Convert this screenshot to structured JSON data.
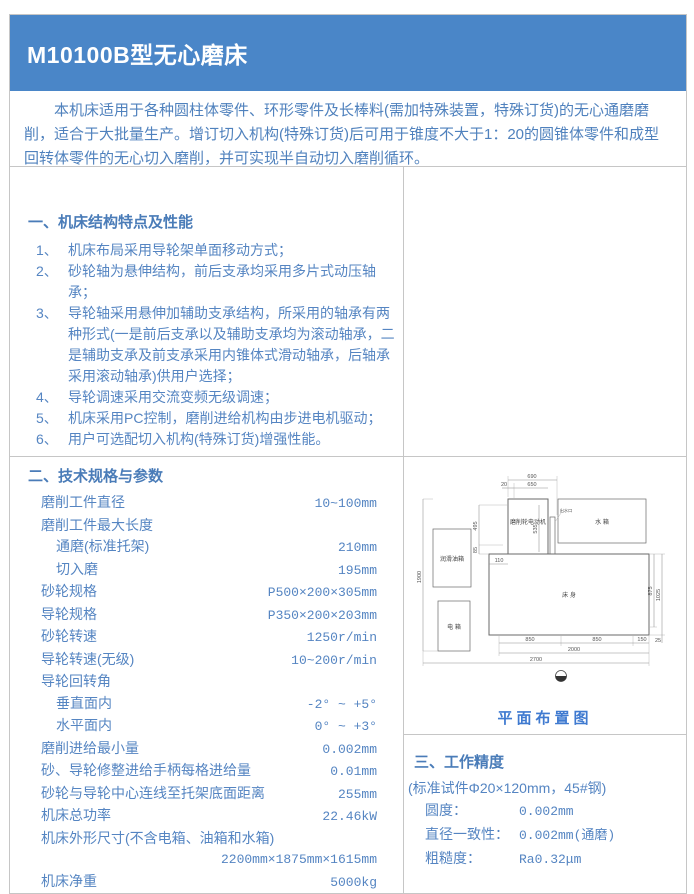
{
  "page": {
    "title": "M10100B型无心磨床"
  },
  "intro": {
    "text": "本机床适用于各种圆柱体零件、环形零件及长棒料(需加特殊装置，特殊订货)的无心通磨磨削，适合于大批量生产。增订切入机构(特殊订货)后可用于锥度不大于1：20的圆锥体零件和成型回转体零件的无心切入磨削，并可实现半自动切入磨削循环。"
  },
  "features": {
    "heading": "一、机床结构特点及性能",
    "items": [
      {
        "num": "1、",
        "text": "机床布局采用导轮架单面移动方式；"
      },
      {
        "num": "2、",
        "text": "砂轮轴为悬伸结构，前后支承均采用多片式动压轴承；"
      },
      {
        "num": "3、",
        "text": "导轮轴采用悬伸加辅助支承结构，所采用的轴承有两种形式(一是前后支承以及辅助支承均为滚动轴承，二是辅助支承及前支承采用内锥体式滑动轴承，后轴承采用滚动轴承)供用户选择；"
      },
      {
        "num": "4、",
        "text": "导轮调速采用交流变频无级调速；"
      },
      {
        "num": "5、",
        "text": "机床采用PC控制，磨削进给机构由步进电机驱动；"
      },
      {
        "num": "6、",
        "text": "用户可选配切入机构(特殊订货)增强性能。"
      }
    ]
  },
  "specs": {
    "heading": "二、技术规格与参数",
    "rows": [
      {
        "label": "磨削工件直径",
        "value": "10~100mm"
      },
      {
        "label": "磨削工件最大长度",
        "value": ""
      },
      {
        "label": "通磨(标准托架)",
        "value": "210mm"
      },
      {
        "label": "切入磨",
        "value": "195mm"
      },
      {
        "label": "砂轮规格",
        "value": "P500×200×305mm"
      },
      {
        "label": "导轮规格",
        "value": "P350×200×203mm"
      },
      {
        "label": "砂轮转速",
        "value": "1250r/min"
      },
      {
        "label": "导轮转速(无级)",
        "value": "10~200r/min"
      },
      {
        "label": "导轮回转角",
        "value": ""
      },
      {
        "label": "垂直面内",
        "value": "-2° ~ +5°"
      },
      {
        "label": "水平面内",
        "value": "0° ~ +3°"
      },
      {
        "label": "磨削进给最小量",
        "value": "0.002mm"
      },
      {
        "label": "砂、导轮修整进给手柄每格进给量",
        "value": "0.01mm"
      },
      {
        "label": "砂轮与导轮中心连线至托架底面距离",
        "value": "255mm"
      },
      {
        "label": "机床总功率",
        "value": "22.46kW"
      },
      {
        "label": "机床外形尺寸(不含电箱、油箱和水箱)",
        "value": ""
      },
      {
        "label": "",
        "value": "2200mm×1875mm×1615mm"
      },
      {
        "label": "机床净重",
        "value": "5000kg"
      }
    ]
  },
  "diagram": {
    "caption": "平面布置图",
    "labels": {
      "bed": "床 身",
      "motor": "磨削轮电动机",
      "water_tank": "水 箱",
      "oil_tank": "润滑油箱",
      "electric_box": "电 箱",
      "outlet": "出水口"
    },
    "dims": [
      "690",
      "20",
      "650",
      "495",
      "85",
      "535",
      "110",
      "1900",
      "875",
      "1025",
      "850",
      "850",
      "150",
      "2000",
      "2700",
      "25"
    ]
  },
  "accuracy": {
    "heading": "三、工作精度",
    "subtitle": "(标准试件Φ20×120mm，45#钢)",
    "rows": [
      {
        "label": "圆度：",
        "value": "0.002mm"
      },
      {
        "label": "直径一致性：",
        "value": "0.002mm(通磨)"
      },
      {
        "label": "粗糙度：",
        "value": "Ra0.32μm"
      }
    ]
  },
  "colors": {
    "header_bg": "#4a86c8",
    "text_blue": "#4f81bd",
    "border": "#c6c6c6"
  }
}
